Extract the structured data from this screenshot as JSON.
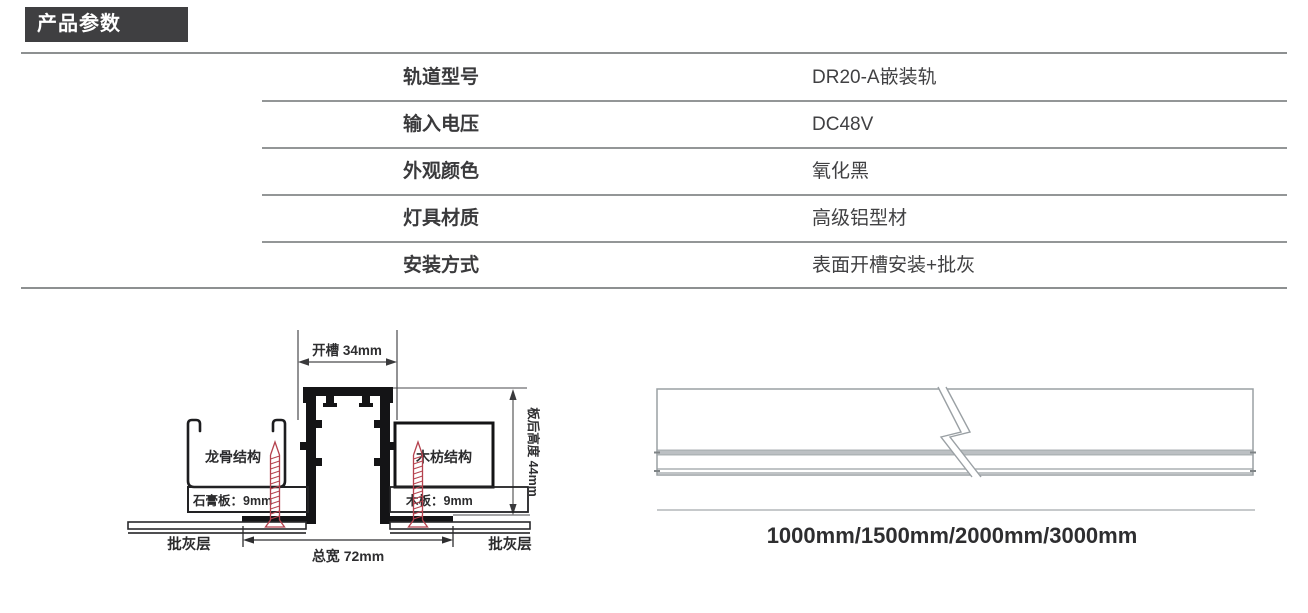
{
  "header": {
    "title": "产品参数"
  },
  "table": {
    "rows": [
      {
        "label": "轨道型号",
        "value": "DR20-A嵌装轨"
      },
      {
        "label": "输入电压",
        "value": "DC48V"
      },
      {
        "label": "外观颜色",
        "value": "氧化黑"
      },
      {
        "label": "灯具材质",
        "value": "高级铝型材"
      },
      {
        "label": "安装方式",
        "value": "表面开槽安装+批灰"
      }
    ]
  },
  "diagram_left": {
    "slot_width_label": "开槽 34mm",
    "board_height_label": "板后高度 44mm",
    "keel_label": "龙骨结构",
    "wood_frame_label": "木枋结构",
    "gypsum_label": "石膏板：9mm",
    "wood_board_label": "木板：9mm",
    "plaster_left_label": "批灰层",
    "plaster_right_label": "批灰层",
    "total_width_label": "总宽 72mm",
    "screw_color": "#b5424e",
    "line_color": "#1d1d1f"
  },
  "diagram_right": {
    "lengths_label": "1000mm/1500mm/2000mm/3000mm",
    "line_color": "#9aa0a4",
    "band_fill": "#bcc0c3"
  },
  "colors": {
    "badge_bg": "#3f3f41",
    "rule_gray": "#8d9091",
    "text_dark": "#3a3a3c"
  }
}
